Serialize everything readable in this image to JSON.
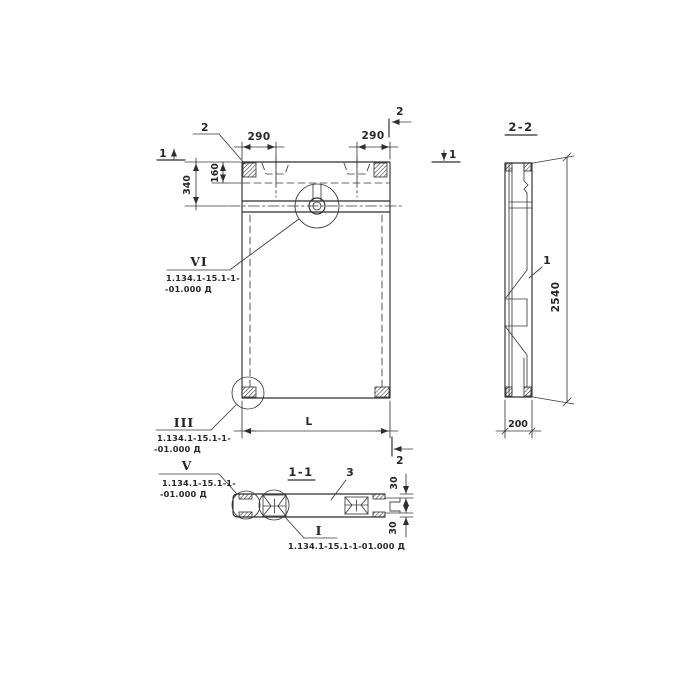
{
  "colors": {
    "ink": "#2e2e2e",
    "background": "#ffffff"
  },
  "main_view": {
    "dim_290_left": "290",
    "dim_290_right": "290",
    "dim_160": "160",
    "dim_340": "340",
    "dim_length": "L",
    "callout_upper_label": "2",
    "cut_mark_1_left": "1",
    "cut_mark_1_right": "1",
    "cut_mark_2_top": "2",
    "cut_mark_2_bottom": "2",
    "detail_vi": {
      "numeral": "VI",
      "ref1": "1.134.1-15.1-1-",
      "ref2": "-01.000 Д"
    },
    "detail_iii": {
      "numeral": "III",
      "ref1": "1.134.1-15.1-1-",
      "ref2": "-01.000 Д"
    }
  },
  "section_2_2": {
    "label": "2-2",
    "part_mark": "1",
    "dim_height": "2540",
    "dim_thickness": "200"
  },
  "section_1_1": {
    "label": "1-1",
    "part_mark": "3",
    "dim_30_top": "30",
    "dim_30_bottom": "30",
    "detail_v": {
      "numeral": "V",
      "ref1": "1.134.1-15.1-1-",
      "ref2": "-01.000 Д"
    },
    "detail_i": {
      "numeral": "I",
      "ref": "1.134.1-15.1-1-01.000 Д"
    }
  }
}
